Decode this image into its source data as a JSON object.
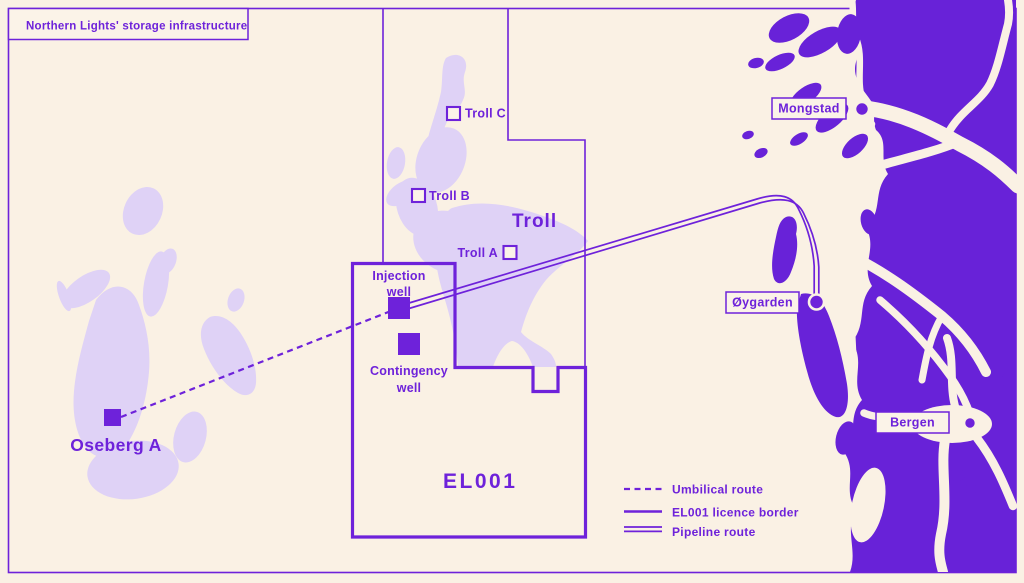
{
  "title": "Northern Lights' storage infrastructure",
  "map": {
    "licence_label": "EL001",
    "field_label": "Troll",
    "platforms": [
      {
        "label": "Troll C"
      },
      {
        "label": "Troll B"
      },
      {
        "label": "Troll A"
      },
      {
        "label": "Oseberg A"
      }
    ],
    "wells": [
      {
        "line1": "Injection",
        "line2": "well"
      },
      {
        "line1": "Contingency",
        "line2": "well"
      }
    ],
    "towns": [
      {
        "label": "Mongstad"
      },
      {
        "label": "Øygarden"
      },
      {
        "label": "Bergen"
      }
    ]
  },
  "legend": {
    "items": [
      {
        "label": "Umbilical route",
        "style": "dashed"
      },
      {
        "label": "EL001 licence border",
        "style": "solid"
      },
      {
        "label": "Pipeline route",
        "style": "double"
      }
    ]
  },
  "colors": {
    "background": "#FAF1E4",
    "accent": "#6E22DA",
    "land": "#6822D8",
    "field": "#DFD2F6"
  }
}
